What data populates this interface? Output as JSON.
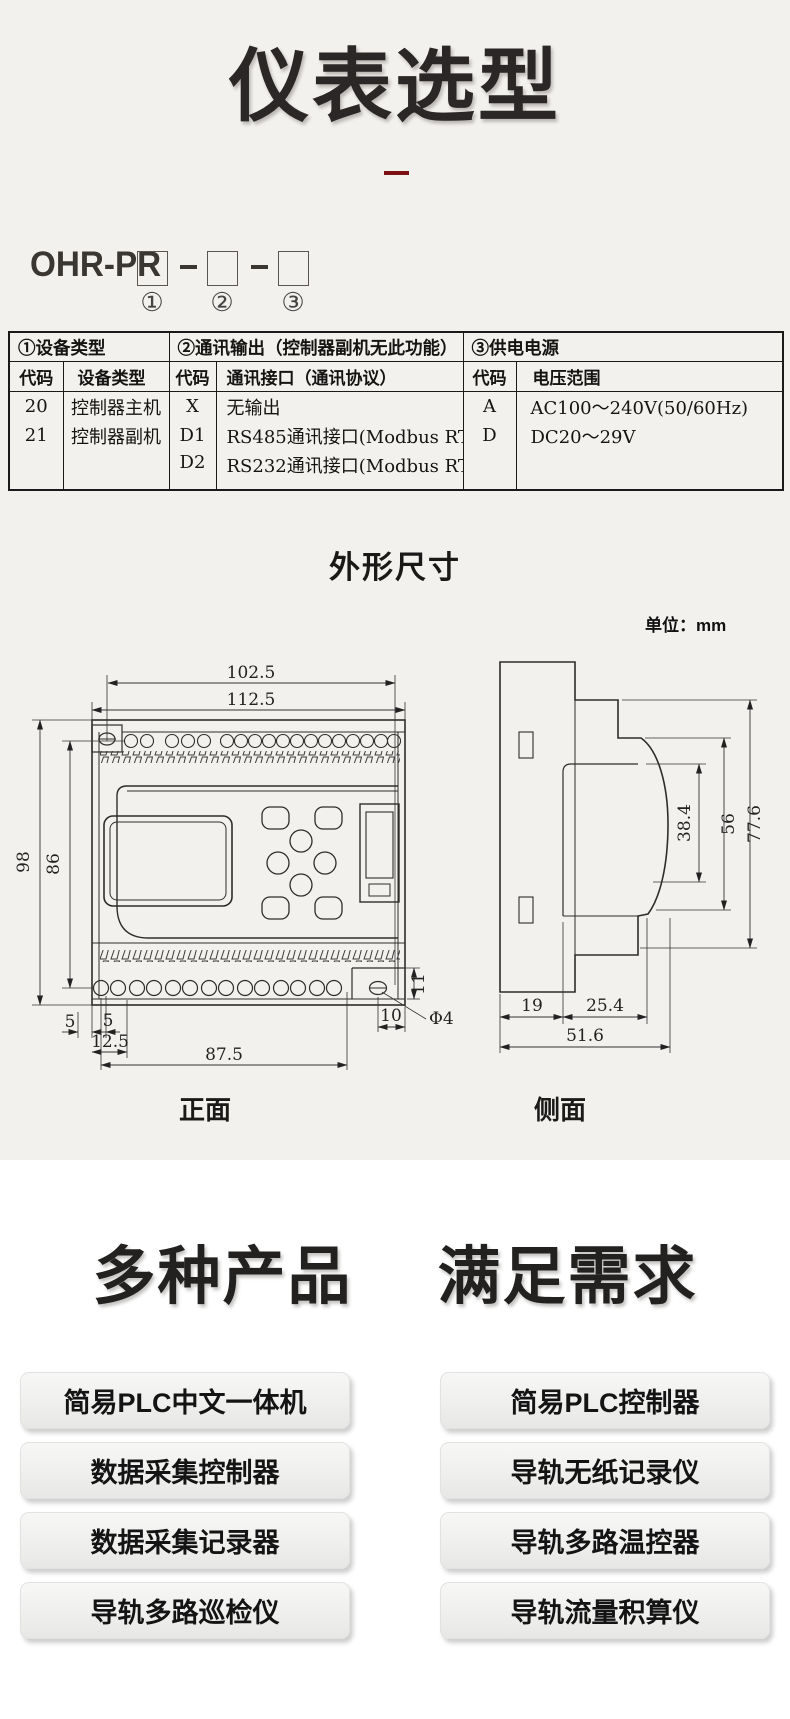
{
  "page": {
    "title": "仪表选型"
  },
  "model_code": {
    "prefix": "OHR-PR",
    "positions": [
      "①",
      "②",
      "③"
    ]
  },
  "selection_table": {
    "groups": [
      {
        "title": "①设备类型",
        "col_headers": [
          "代码",
          "设备类型"
        ],
        "rows": [
          [
            "20",
            "控制器主机"
          ],
          [
            "21",
            "控制器副机"
          ],
          [
            "",
            ""
          ]
        ]
      },
      {
        "title": "②通讯输出（控制器副机无此功能）",
        "col_headers": [
          "代码",
          "通讯接口（通讯协议）"
        ],
        "rows": [
          [
            "X",
            "无输出"
          ],
          [
            "D1",
            "RS485通讯接口(Modbus RTU)"
          ],
          [
            "D2",
            "RS232通讯接口(Modbus RTU)"
          ]
        ]
      },
      {
        "title": "③供电电源",
        "col_headers": [
          "代码",
          "电压范围"
        ],
        "rows": [
          [
            "A",
            "AC100～240V(50/60Hz)"
          ],
          [
            "D",
            "DC20～29V"
          ],
          [
            "",
            ""
          ]
        ]
      }
    ]
  },
  "dimensions_section": {
    "heading": "外形尺寸",
    "unit_label": "单位：mm",
    "front_view": {
      "label": "正面",
      "dims": {
        "top_width": "102.5",
        "full_width": "112.5",
        "height": "98",
        "inner_height": "86",
        "m5a": "5",
        "m5b": "5",
        "pitch": "12.5",
        "span": "87.5",
        "off10": "10",
        "off11": "11",
        "dia": "Φ4"
      }
    },
    "side_view": {
      "label": "侧面",
      "dims": {
        "front_depth": "38.4",
        "mid_depth": "56",
        "full_depth": "77.6",
        "b19": "19",
        "b25": "25.4",
        "b51": "51.6"
      }
    }
  },
  "products_section": {
    "heading_left": "多种产品",
    "heading_right": "满足需求",
    "left_buttons": [
      "简易PLC中文一体机",
      "数据采集控制器",
      "数据采集记录器",
      "导轨多路巡检仪"
    ],
    "right_buttons": [
      "简易PLC控制器",
      "导轨无纸记录仪",
      "导轨多路温控器",
      "导轨流量积算仪"
    ]
  },
  "colors": {
    "accent_red": "#7c1114",
    "bg_top": "#f2f1ee",
    "bg_bottom": "#ffffff",
    "ink": "#232120"
  }
}
